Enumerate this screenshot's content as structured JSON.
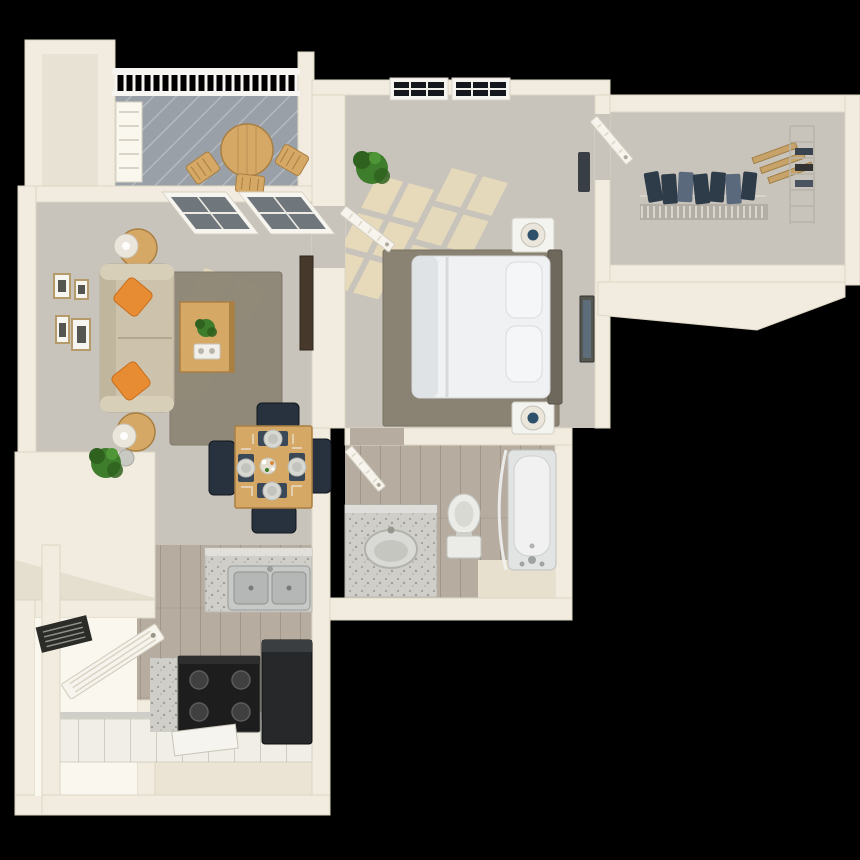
{
  "scene": {
    "description": "3D bird's-eye rendering of a one-bedroom apartment floor plan on a black background",
    "rooms": [
      {
        "name": "patio",
        "floor": "gray deck planks"
      },
      {
        "name": "living-room",
        "floor": "carpet"
      },
      {
        "name": "dining-area",
        "floor": "carpet"
      },
      {
        "name": "kitchen",
        "floor": "wood"
      },
      {
        "name": "bedroom",
        "floor": "carpet"
      },
      {
        "name": "walk-in-closet",
        "floor": "carpet"
      },
      {
        "name": "bathroom",
        "floor": "wood"
      },
      {
        "name": "utility-closet",
        "floor": "none"
      }
    ],
    "furniture": [
      "patio-table",
      "patio-chairs",
      "sofa",
      "throw-pillows",
      "side-tables-with-lamps",
      "coffee-table-with-plant",
      "wall-art-frames",
      "tv-console",
      "dining-table-with-four-chairs",
      "place-settings",
      "breakfast-counter-with-double-sink",
      "stove",
      "refrigerator",
      "base-cabinets",
      "bed",
      "headboard",
      "nightstands-with-lamps",
      "bedroom-windows",
      "corner-plants",
      "closet-rod-with-clothes",
      "wire-shelving",
      "vanity-with-sink",
      "toilet",
      "bathtub",
      "louvered-doors"
    ]
  },
  "palette": {
    "bg": "#000000",
    "wall": "#f1ecdf",
    "wall_bright": "#faf7ef",
    "wall_shade": "#d8d1bf",
    "carpet": "#c8c4bc",
    "wood_floor": "#b6ada0",
    "walkway": "#ebe4d4",
    "platform": "#e8e0ce",
    "deck": "#99a0a7",
    "railing": "#f6f5f1",
    "rug_living": "#8e8676",
    "rug_bedroom": "#8a8272",
    "sun": "#ecdeba",
    "sofa": "#cdc3ac",
    "sofa_arm": "#d8cfb9",
    "sofa_back": "#c0b59d",
    "pillow": "#e88c34",
    "wood_furn": "#d5a866",
    "wood_furn_dark": "#a97f42",
    "chair": "#28323e",
    "placemat": "#3a4857",
    "plate": "#d8d8d3",
    "plate_inner": "#c4c4bf",
    "bed": "#eff1f2",
    "bed_fold": "#dadde0",
    "headboard": "#6e675b",
    "nightstand": "#f3f3f0",
    "lamp_shade": "#eae6db",
    "lamp_navy": "#2f506b",
    "granite": "#cfcec8",
    "fixture": "#ebebe7",
    "tub": "#e2e4e3",
    "tub_inner": "#f0f1f0",
    "stove": "#1d1d1d",
    "burner": "#404040",
    "fridge": "#26282a",
    "fridge_top": "#3b3e40",
    "cabinet": "#f0eee7",
    "clothes": "#2e3b49",
    "clothes_alt": "#5a6a7c",
    "shelf_tan": "#c7a269",
    "plant": "#3e7d2b",
    "plant_dark": "#2f611f",
    "glass": "#6f767c",
    "glass_dark": "#14181c",
    "window_frame": "#f7f5ef",
    "frame_tan": "#b59a6b",
    "art_dark": "#55564f",
    "door": "#f7f4ed",
    "vent": "#2b2b28",
    "console": "#46392c"
  }
}
